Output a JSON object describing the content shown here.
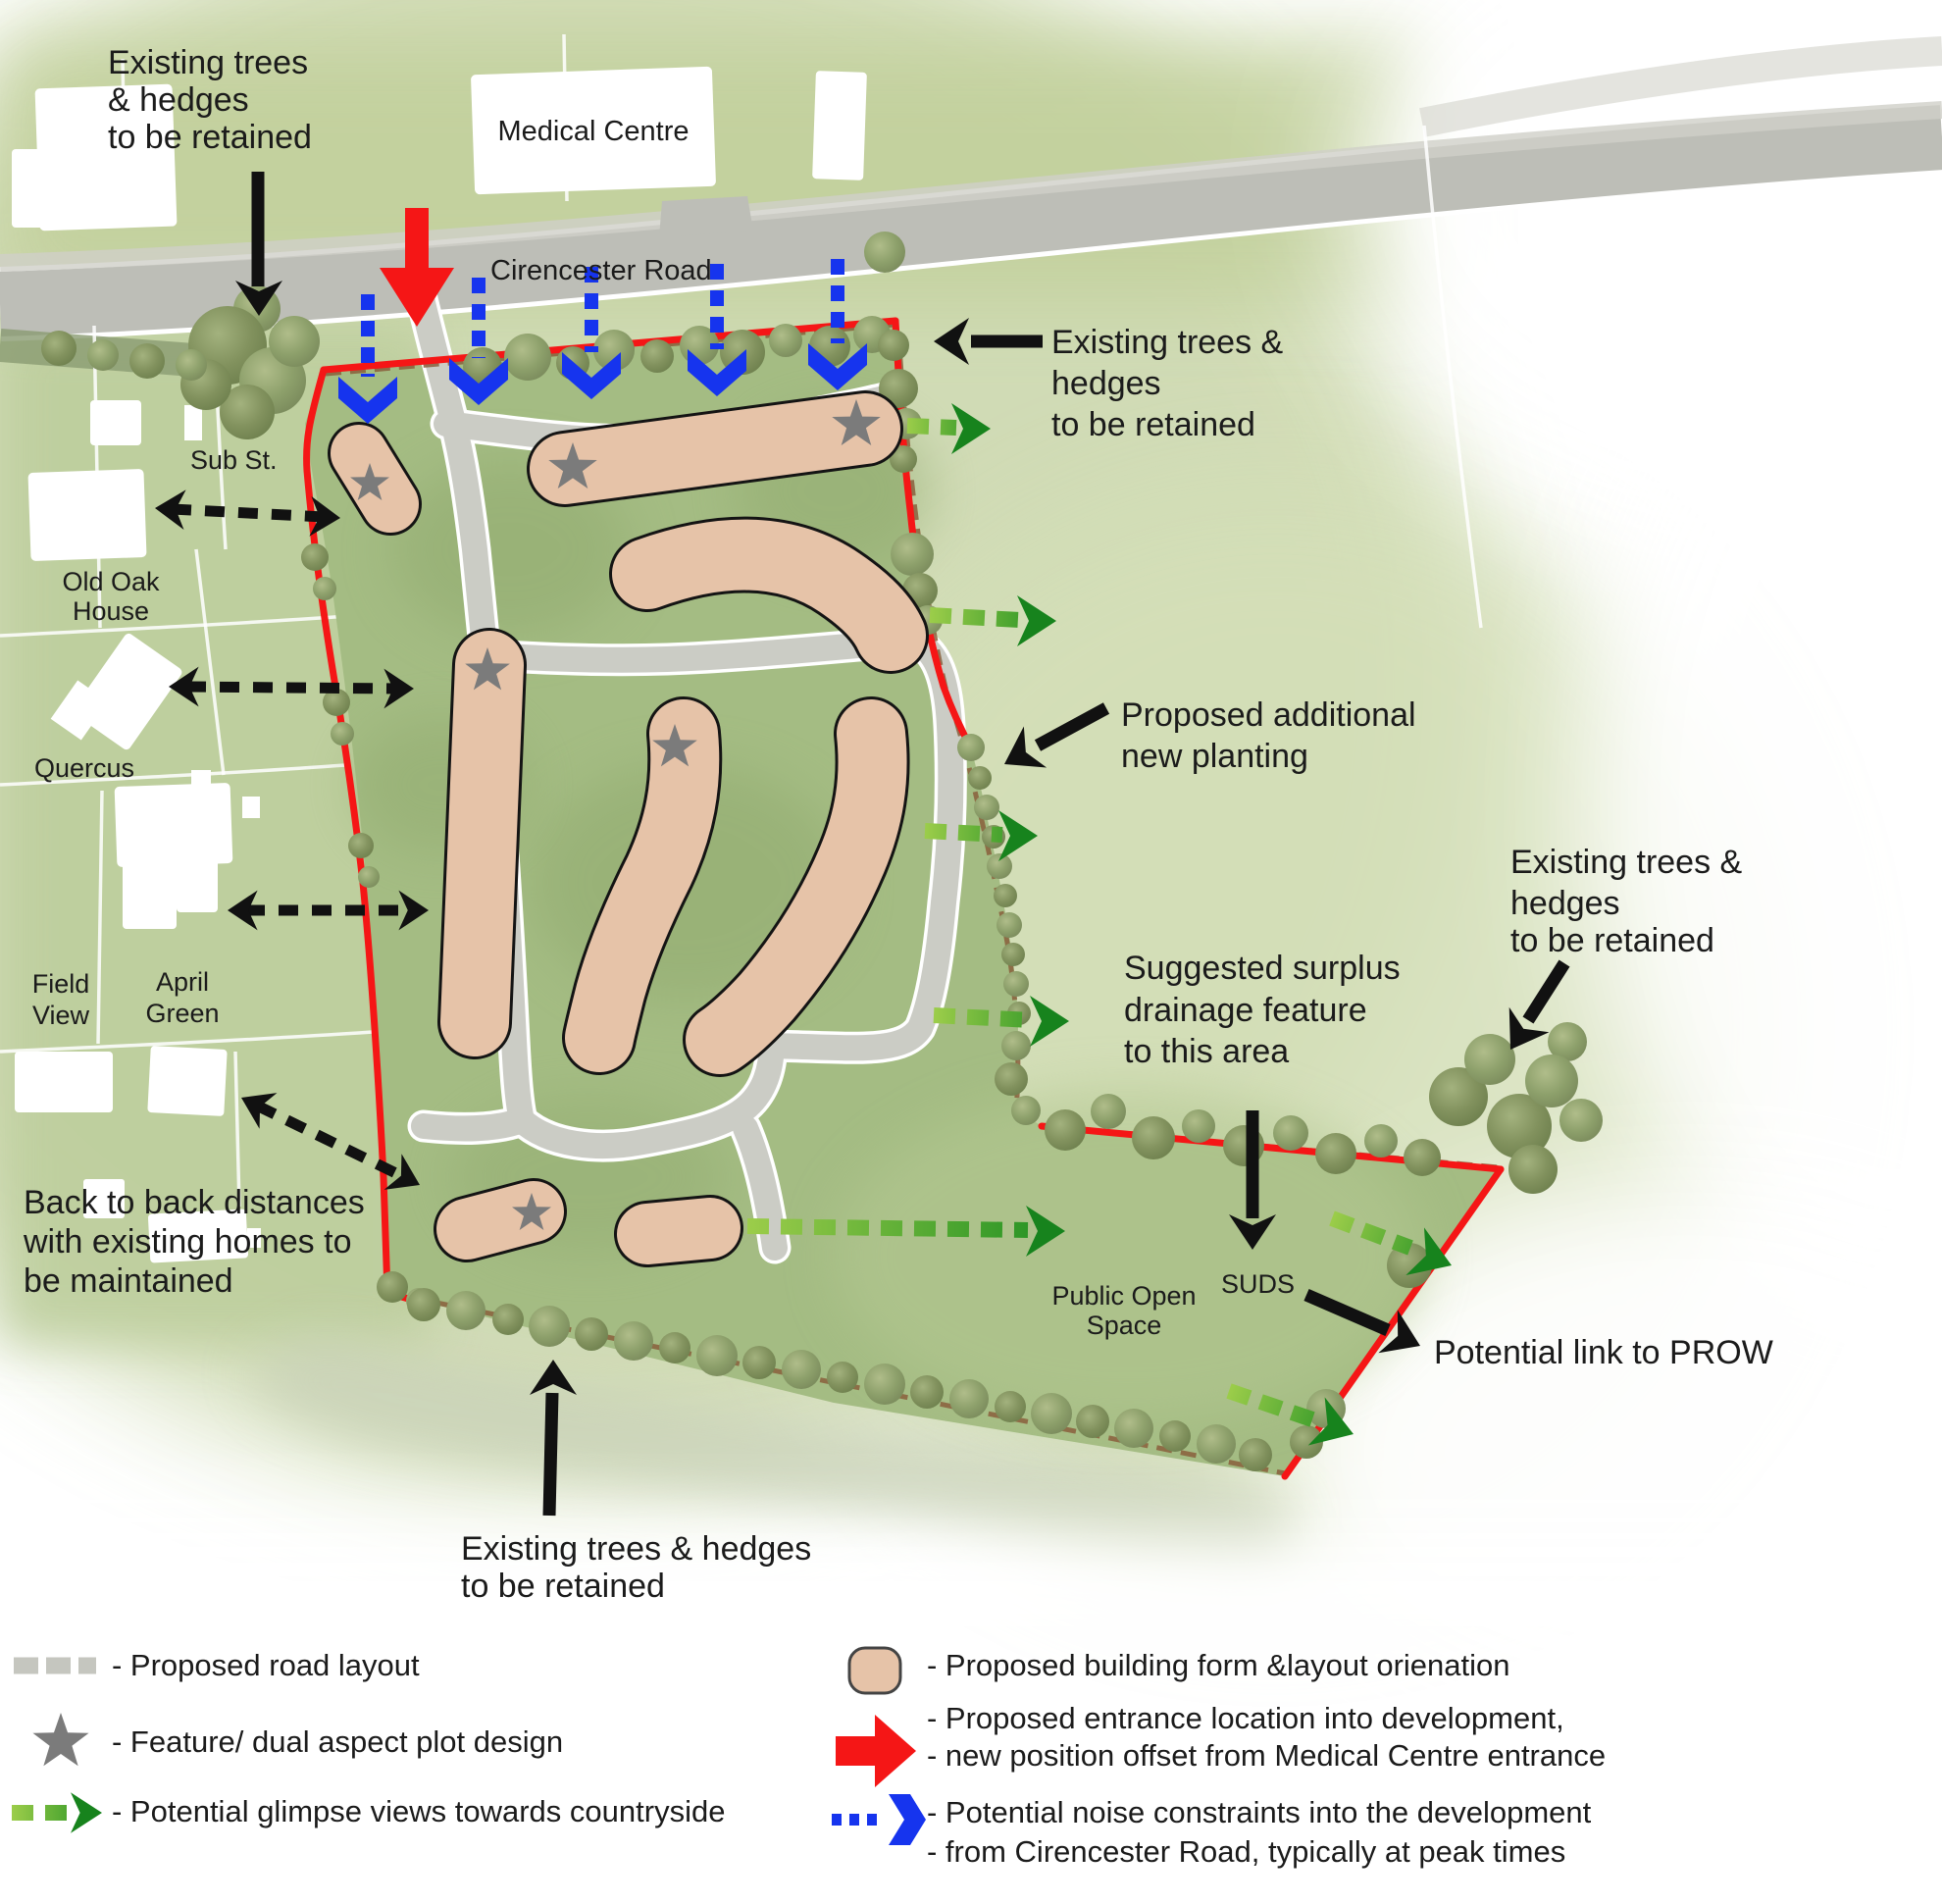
{
  "colors": {
    "site_green": "#a4bc83",
    "outside_green": "#bccd9b",
    "wash_green": "#ccd8ad",
    "road_grey": "#bdbeb7",
    "building_tan": "#e6c3a8",
    "building_outline": "#141414",
    "boundary_red": "#f51616",
    "noise_blue": "#1634ee",
    "glimpse_light_green": "#9ccd4a",
    "glimpse_dark_green": "#17831d",
    "star_grey": "#7b7b7b",
    "hedge_brown": "#8a5f3c",
    "tree_green": "#82925e",
    "text": "#1b1b1b"
  },
  "map_labels": {
    "medical_centre": "Medical Centre",
    "cirencester_road": "Cirencester Road",
    "sub_st": "Sub St.",
    "old_oak_house": [
      "Old Oak",
      "House"
    ],
    "quercus": "Quercus",
    "field_view": [
      "Field",
      "View"
    ],
    "april_green": [
      "April",
      "Green"
    ],
    "public_open_space": [
      "Public Open",
      "Space"
    ],
    "suds": "SUDS"
  },
  "annotations": {
    "trees_top_left": [
      "Existing trees",
      "& hedges",
      "to be retained"
    ],
    "trees_top_right": [
      "Existing trees &",
      "hedges",
      "to be retained"
    ],
    "planting": [
      "Proposed additional",
      "new planting"
    ],
    "trees_far_right": [
      "Existing trees &",
      "hedges",
      "to be retained"
    ],
    "drainage": [
      "Suggested surplus",
      "drainage feature",
      "to this area"
    ],
    "back_to_back": [
      "Back to back distances",
      "with existing homes to",
      "be maintained"
    ],
    "trees_bottom": [
      "Existing trees & hedges",
      "to be retained"
    ],
    "prow": "Potential link to PROW"
  },
  "legend": {
    "road": "- Proposed road layout",
    "feature": "- Feature/ dual aspect plot design",
    "glimpse": "- Potential glimpse views towards countryside",
    "building": "- Proposed building form &layout orienation",
    "entrance": [
      "- Proposed entrance location into development,",
      "- new position offset from Medical Centre entrance"
    ],
    "noise": [
      "- Potential noise constraints into the development",
      "- from Cirencester Road, typically at peak times"
    ]
  }
}
